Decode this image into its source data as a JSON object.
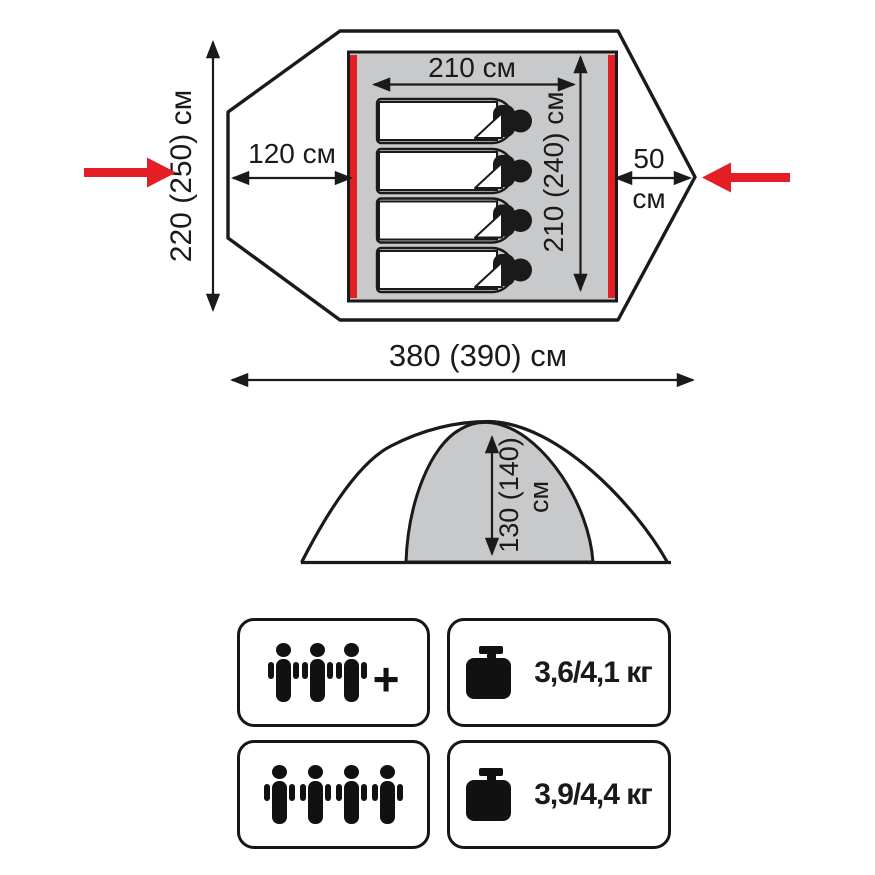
{
  "top_view": {
    "total_width_label": "220 (250) см",
    "left_vestibule_label": "120 см",
    "inner_width_label": "210 см",
    "inner_length_label": "210 (240) см",
    "right_vestibule_value": "50",
    "right_vestibule_unit": "см",
    "total_length_label": "380 (390) см",
    "sleeping_places": 4
  },
  "side_view": {
    "height_value": "130 (140)",
    "height_unit": "см"
  },
  "specs": {
    "capacity_min": {
      "person_count": 3,
      "plus_sign": "+"
    },
    "weight_min": {
      "label": "3,6/4,1 кг"
    },
    "capacity_max": {
      "person_count": 4
    },
    "weight_max": {
      "label": "3,9/4,4 кг"
    }
  },
  "colors": {
    "accent_red": "#e31e24",
    "diagram_gray": "#c8c9cb",
    "line_black": "#1a1a1a"
  }
}
